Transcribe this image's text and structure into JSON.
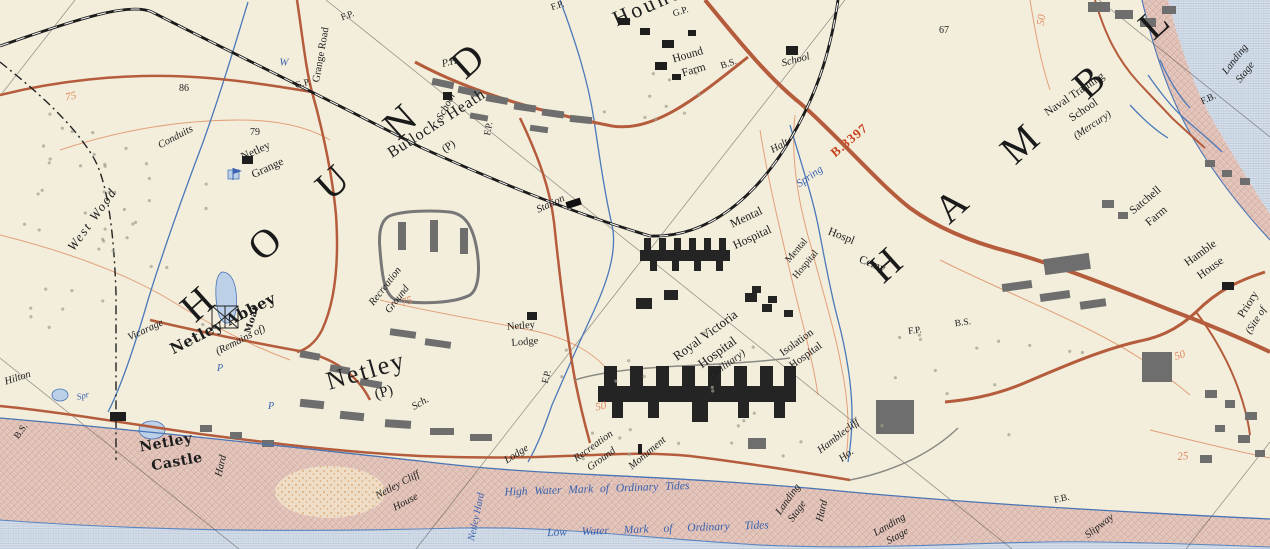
{
  "map": {
    "colors": {
      "paper": "#f3eedc",
      "ink": "#1d1d1d",
      "road": "#b45c3c",
      "roadNumber": "#c8401c",
      "water": "#d6dfe9",
      "mud": "#e3c9c0",
      "stream": "#4a78b8",
      "contour": "#dd8558",
      "rail": "#1c1c1c",
      "blueText": "#3a62b0"
    },
    "labels": [
      {
        "text": "H O U N D",
        "x": 342,
        "y": 174,
        "rot": -42,
        "cls": "district"
      },
      {
        "text": "H A M B L E",
        "x": 1060,
        "y": 108,
        "rot": -42,
        "cls": "district"
      },
      {
        "text": "Hound",
        "x": 648,
        "y": 5,
        "rot": -24,
        "cls": "hamlet-big"
      },
      {
        "text": "Netley",
        "x": 366,
        "y": 371,
        "rot": -16,
        "cls": "town"
      },
      {
        "text": "(P)",
        "x": 384,
        "y": 393,
        "rot": -16,
        "cls": "town-sub"
      },
      {
        "text": "Butlocks Heath",
        "x": 437,
        "y": 124,
        "rot": -33,
        "cls": "town2"
      },
      {
        "text": "(P)",
        "x": 449,
        "y": 147,
        "rot": -33,
        "cls": "abbr",
        "fs": 11
      },
      {
        "text": "Netley",
        "x": 256,
        "y": 152,
        "rot": -25,
        "cls": "name"
      },
      {
        "text": "Grange",
        "x": 268,
        "y": 169,
        "rot": -25,
        "cls": "name"
      },
      {
        "text": "Hound",
        "x": 688,
        "y": 56,
        "rot": -16,
        "cls": "name"
      },
      {
        "text": "Farm",
        "x": 694,
        "y": 71,
        "rot": -16,
        "cls": "name"
      },
      {
        "text": "Satchell",
        "x": 1146,
        "y": 201,
        "rot": -40,
        "cls": "name"
      },
      {
        "text": "Farm",
        "x": 1157,
        "y": 217,
        "rot": -40,
        "cls": "name"
      },
      {
        "text": "Hamble",
        "x": 1201,
        "y": 254,
        "rot": -36,
        "cls": "name"
      },
      {
        "text": "House",
        "x": 1211,
        "y": 269,
        "rot": -36,
        "cls": "name"
      },
      {
        "text": "Mental",
        "x": 746,
        "y": 217,
        "rot": -25,
        "cls": "name",
        "fs": 12
      },
      {
        "text": "Hospital",
        "x": 752,
        "y": 237,
        "rot": -25,
        "cls": "name",
        "fs": 12
      },
      {
        "text": "Mental",
        "x": 797,
        "y": 251,
        "rot": -50,
        "cls": "name",
        "fs": 10
      },
      {
        "text": "Hospital",
        "x": 806,
        "y": 265,
        "rot": -50,
        "cls": "name",
        "fs": 10
      },
      {
        "text": "Hospl",
        "x": 841,
        "y": 237,
        "rot": 22,
        "cls": "name"
      },
      {
        "text": "Cemy",
        "x": 872,
        "y": 265,
        "rot": 22,
        "cls": "name"
      },
      {
        "text": "Royal Victoria",
        "x": 705,
        "y": 335,
        "rot": -36,
        "cls": "name",
        "fs": 13
      },
      {
        "text": "Hospital",
        "x": 717,
        "y": 352,
        "rot": -36,
        "cls": "name",
        "fs": 13
      },
      {
        "text": "(Military)",
        "x": 728,
        "y": 365,
        "rot": -36,
        "cls": "ital"
      },
      {
        "text": "Isolation",
        "x": 797,
        "y": 343,
        "rot": -36,
        "cls": "name",
        "fs": 11
      },
      {
        "text": "Hospital",
        "x": 806,
        "y": 356,
        "rot": -36,
        "cls": "name",
        "fs": 11
      },
      {
        "text": "Naval Training",
        "x": 1075,
        "y": 95,
        "rot": -34,
        "cls": "name"
      },
      {
        "text": "School",
        "x": 1084,
        "y": 111,
        "rot": -34,
        "cls": "name"
      },
      {
        "text": "(Mercury)",
        "x": 1093,
        "y": 126,
        "rot": -34,
        "cls": "ital"
      },
      {
        "text": "Priory",
        "x": 1249,
        "y": 305,
        "rot": -58,
        "cls": "name"
      },
      {
        "text": "(Site of",
        "x": 1257,
        "y": 321,
        "rot": -58,
        "cls": "ital"
      },
      {
        "text": "Grange Road",
        "x": 322,
        "y": 55,
        "rot": -80,
        "cls": "name",
        "fs": 10.5
      },
      {
        "text": "Netley",
        "x": 521,
        "y": 327,
        "rot": -5,
        "cls": "name",
        "fs": 10.5
      },
      {
        "text": "Lodge",
        "x": 525,
        "y": 343,
        "rot": -5,
        "cls": "name",
        "fs": 10.5
      },
      {
        "text": "Netley Abbey",
        "x": 223,
        "y": 324,
        "rot": -27,
        "cls": "gothic",
        "fs": 15
      },
      {
        "text": "(Remains of)",
        "x": 241,
        "y": 341,
        "rot": -27,
        "cls": "ital"
      },
      {
        "text": "Moat",
        "x": 253,
        "y": 320,
        "rot": -72,
        "cls": "gothic",
        "fs": 9
      },
      {
        "text": "Netley",
        "x": 166,
        "y": 443,
        "rot": -10,
        "cls": "gothic"
      },
      {
        "text": "Castle",
        "x": 177,
        "y": 462,
        "rot": -10,
        "cls": "gothic"
      },
      {
        "text": "West Wood",
        "x": 92,
        "y": 219,
        "rot": -54,
        "cls": "ital",
        "fs": 13,
        "ls": 2
      },
      {
        "text": "Vicarage",
        "x": 146,
        "y": 331,
        "rot": -25,
        "cls": "ital"
      },
      {
        "text": "Hilton",
        "x": 18,
        "y": 379,
        "rot": -18,
        "cls": "ital"
      },
      {
        "text": "Conduits",
        "x": 176,
        "y": 138,
        "rot": -28,
        "cls": "ital"
      },
      {
        "text": "School",
        "x": 447,
        "y": 107,
        "rot": -62,
        "cls": "ital"
      },
      {
        "text": "School",
        "x": 796,
        "y": 61,
        "rot": -15,
        "cls": "ital"
      },
      {
        "text": "Sch.",
        "x": 421,
        "y": 404,
        "rot": -30,
        "cls": "ital"
      },
      {
        "text": "P.H.",
        "x": 451,
        "y": 63,
        "rot": -15,
        "cls": "ital"
      },
      {
        "text": "Station",
        "x": 551,
        "y": 205,
        "rot": -25,
        "cls": "ital"
      },
      {
        "text": "Halt",
        "x": 780,
        "y": 147,
        "rot": -30,
        "cls": "ital"
      },
      {
        "text": "Lodge",
        "x": 517,
        "y": 455,
        "rot": -32,
        "cls": "ital"
      },
      {
        "text": "Netley Cliff",
        "x": 398,
        "y": 486,
        "rot": -28,
        "cls": "ital"
      },
      {
        "text": "House",
        "x": 406,
        "y": 503,
        "rot": -28,
        "cls": "ital"
      },
      {
        "text": "Hamblecliff",
        "x": 839,
        "y": 437,
        "rot": -38,
        "cls": "ital"
      },
      {
        "text": "Ho.",
        "x": 847,
        "y": 456,
        "rot": -38,
        "cls": "ital"
      },
      {
        "text": "Recreation",
        "x": 386,
        "y": 287,
        "rot": -52,
        "cls": "ital"
      },
      {
        "text": "Ground",
        "x": 398,
        "y": 300,
        "rot": -52,
        "cls": "ital"
      },
      {
        "text": "Recreation",
        "x": 594,
        "y": 447,
        "rot": -36,
        "cls": "ital"
      },
      {
        "text": "Ground",
        "x": 602,
        "y": 460,
        "rot": -36,
        "cls": "ital"
      },
      {
        "text": "Monument",
        "x": 648,
        "y": 454,
        "rot": -40,
        "cls": "ital"
      },
      {
        "text": "Landing",
        "x": 789,
        "y": 500,
        "rot": -55,
        "cls": "ital"
      },
      {
        "text": "Stage",
        "x": 798,
        "y": 512,
        "rot": -55,
        "cls": "ital"
      },
      {
        "text": "Landing",
        "x": 890,
        "y": 526,
        "rot": -30,
        "cls": "ital"
      },
      {
        "text": "Stage",
        "x": 898,
        "y": 537,
        "rot": -30,
        "cls": "ital"
      },
      {
        "text": "Landing",
        "x": 1236,
        "y": 60,
        "rot": -52,
        "cls": "ital"
      },
      {
        "text": "Stage",
        "x": 1246,
        "y": 73,
        "rot": -52,
        "cls": "ital"
      },
      {
        "text": "Slipway",
        "x": 1100,
        "y": 527,
        "rot": -38,
        "cls": "ital"
      },
      {
        "text": "Hard",
        "x": 222,
        "y": 466,
        "rot": -76,
        "cls": "ital"
      },
      {
        "text": "Hard",
        "x": 823,
        "y": 511,
        "rot": -76,
        "cls": "ital"
      },
      {
        "text": "Spring",
        "x": 810,
        "y": 177,
        "rot": -35,
        "cls": "blue"
      },
      {
        "text": "Spr",
        "x": 83,
        "y": 396,
        "rot": -15,
        "cls": "blue",
        "fs": 9
      },
      {
        "text": "Netley Hard",
        "x": 477,
        "y": 517,
        "rot": -78,
        "cls": "blue",
        "fs": 10
      },
      {
        "text": "W",
        "x": 284,
        "y": 63,
        "rot": 0,
        "cls": "blue",
        "fs": 11
      },
      {
        "text": "P",
        "x": 220,
        "y": 369,
        "rot": 0,
        "cls": "blue",
        "fs": 10
      },
      {
        "text": "P",
        "x": 271,
        "y": 407,
        "rot": 0,
        "cls": "blue",
        "fs": 10
      },
      {
        "text": "High Water Mark of Ordinary Tides",
        "x": 597,
        "y": 490,
        "rot": -2,
        "cls": "tide",
        "ws": 4
      },
      {
        "text": "Low Water Mark of Ordinary Tides",
        "x": 658,
        "y": 530,
        "rot": -2,
        "cls": "tide",
        "ws": 12
      },
      {
        "text": "75",
        "x": 71,
        "y": 97,
        "rot": -12,
        "cls": "contour"
      },
      {
        "text": "75",
        "x": 407,
        "y": 302,
        "rot": -18,
        "cls": "contour"
      },
      {
        "text": "50",
        "x": 1042,
        "y": 20,
        "rot": -82,
        "cls": "contour"
      },
      {
        "text": "50",
        "x": 601,
        "y": 407,
        "rot": -12,
        "cls": "contour"
      },
      {
        "text": "50",
        "x": 1180,
        "y": 356,
        "rot": -18,
        "cls": "contour"
      },
      {
        "text": "25",
        "x": 1183,
        "y": 457,
        "rot": -6,
        "cls": "contour"
      },
      {
        "text": "86",
        "x": 184,
        "y": 89,
        "rot": 0,
        "cls": "spot"
      },
      {
        "text": "79",
        "x": 255,
        "y": 133,
        "rot": 0,
        "cls": "spot"
      },
      {
        "text": "67",
        "x": 944,
        "y": 31,
        "rot": 0,
        "cls": "spot"
      },
      {
        "text": "B.3397",
        "x": 849,
        "y": 140,
        "rot": -40,
        "cls": "roadnum"
      },
      {
        "text": "F.P.",
        "x": 348,
        "y": 17,
        "rot": -20,
        "cls": "abbr"
      },
      {
        "text": "F.P.",
        "x": 558,
        "y": 7,
        "rot": -18,
        "cls": "abbr"
      },
      {
        "text": "F.P.",
        "x": 490,
        "y": 129,
        "rot": -80,
        "cls": "abbr"
      },
      {
        "text": "F.P.",
        "x": 548,
        "y": 377,
        "rot": -75,
        "cls": "abbr"
      },
      {
        "text": "F.P.",
        "x": 915,
        "y": 332,
        "rot": -8,
        "cls": "abbr"
      },
      {
        "text": "F.B.",
        "x": 1209,
        "y": 100,
        "rot": -24,
        "cls": "abbr"
      },
      {
        "text": "F.B.",
        "x": 1062,
        "y": 500,
        "rot": -12,
        "cls": "abbr"
      },
      {
        "text": "B.S.",
        "x": 729,
        "y": 65,
        "rot": -18,
        "cls": "abbr"
      },
      {
        "text": "B.S.",
        "x": 963,
        "y": 324,
        "rot": -8,
        "cls": "abbr"
      },
      {
        "text": "B.S.",
        "x": 22,
        "y": 432,
        "rot": -55,
        "cls": "abbr"
      },
      {
        "text": "G.P.",
        "x": 303,
        "y": 85,
        "rot": -14,
        "cls": "abbr"
      },
      {
        "text": "G.P.",
        "x": 681,
        "y": 13,
        "rot": -18,
        "cls": "abbr"
      }
    ]
  }
}
